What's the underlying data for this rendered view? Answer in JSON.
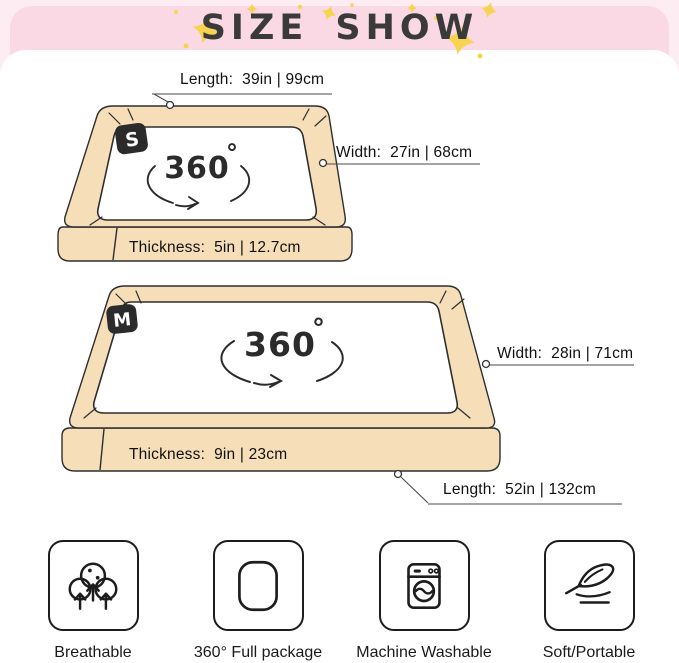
{
  "header": {
    "title": "SIZE SHOW"
  },
  "beds": {
    "s": {
      "badge": "S",
      "spin": "360",
      "spin_unit": "°",
      "length": "Length:  39in | 99cm",
      "width": "Width:  27in | 68cm",
      "thickness": "Thickness:  5in | 12.7cm"
    },
    "m": {
      "badge": "M",
      "spin": "360",
      "spin_unit": "°",
      "length": "Length:  52in | 132cm",
      "width": "Width:  28in | 71cm",
      "thickness": "Thickness:  9in | 23cm"
    }
  },
  "features": [
    {
      "icon": "breathable-icon",
      "label": "Breathable"
    },
    {
      "icon": "full-package-icon",
      "label": "360° Full package"
    },
    {
      "icon": "machine-washable-icon",
      "label": "Machine Washable"
    },
    {
      "icon": "soft-portable-icon",
      "label": "Soft/Portable"
    }
  ],
  "colors": {
    "background_pink": "#fdecf2",
    "band_pink": "#fbd9e4",
    "star_yellow": "#f6d44f",
    "bed_beige": "#f5deb8",
    "outline": "#2e2e2e",
    "title_text": "#3a3a3a"
  }
}
